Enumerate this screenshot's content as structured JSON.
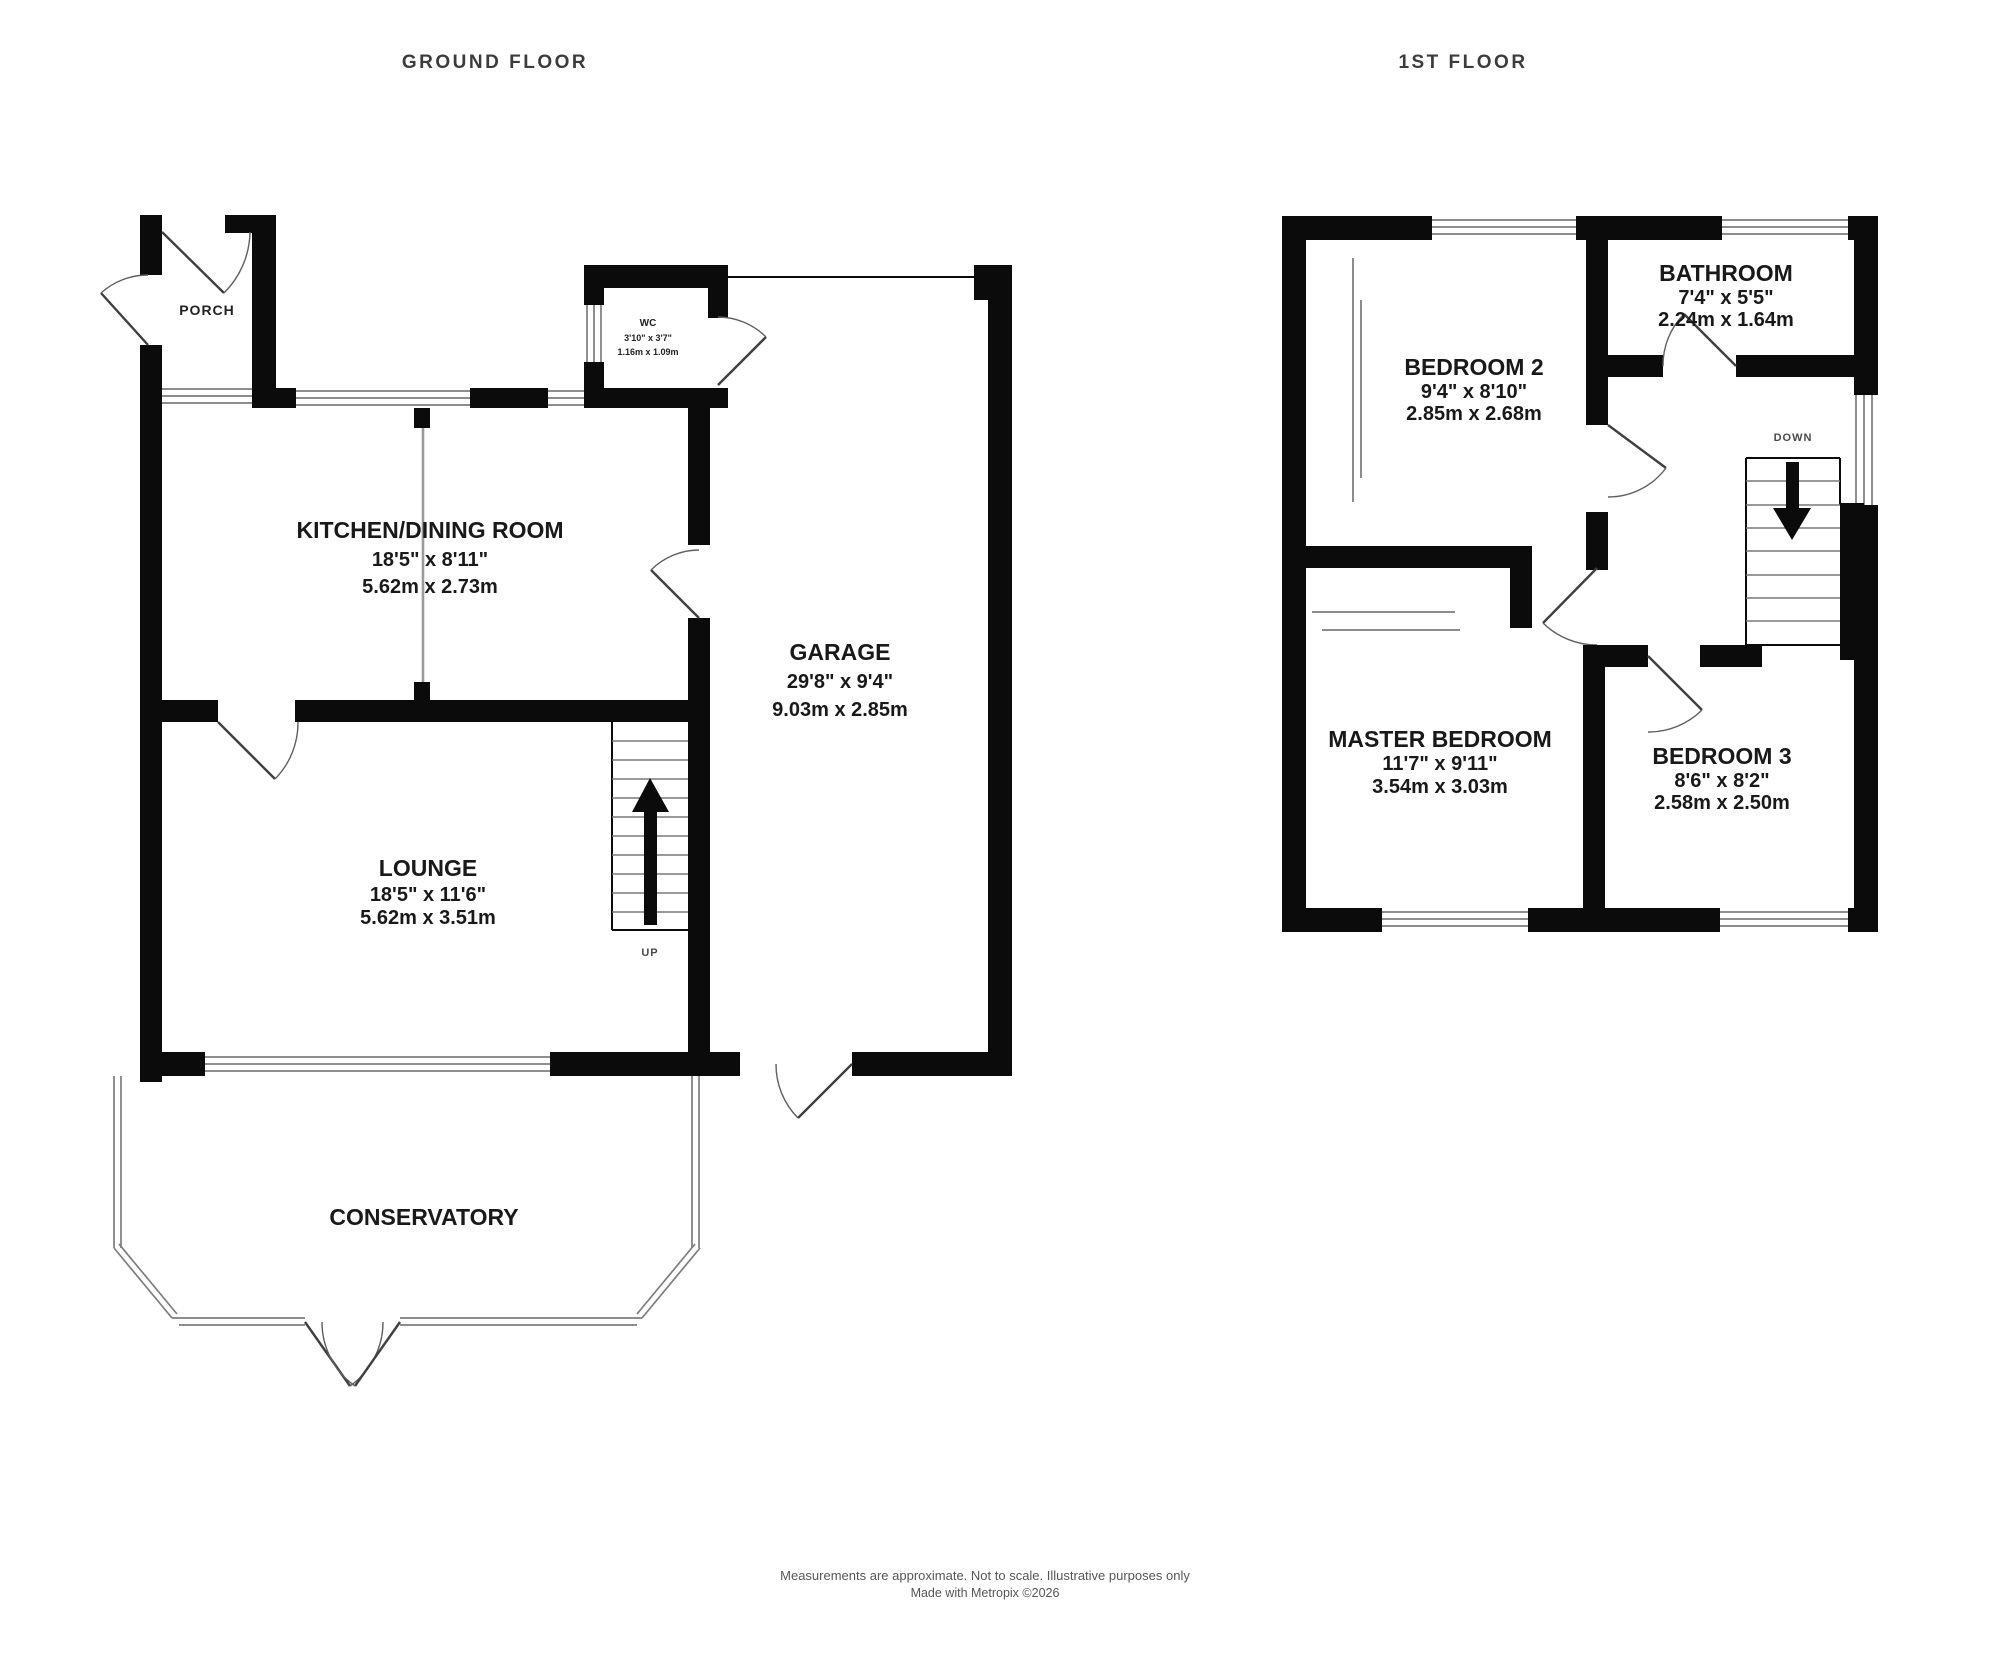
{
  "titles": {
    "ground": "GROUND FLOOR",
    "first": "1ST FLOOR"
  },
  "colors": {
    "wall": "#0b0b0b",
    "window_line": "#7d7d7d",
    "furniture_line": "#9a9a9a",
    "text": "#191919"
  },
  "ground": {
    "porch": {
      "label": "PORCH"
    },
    "wc": {
      "label": "WC",
      "imperial": "3'10\" x 3'7\"",
      "metric": "1.16m x 1.09m"
    },
    "kitchen": {
      "label": "KITCHEN/DINING ROOM",
      "imperial": "18'5\"  x 8'11\"",
      "metric": "5.62m  x 2.73m"
    },
    "garage": {
      "label": "GARAGE",
      "imperial": "29'8\"  x 9'4\"",
      "metric": "9.03m  x 2.85m"
    },
    "lounge": {
      "label": "LOUNGE",
      "imperial": "18'5\"  x 11'6\"",
      "metric": "5.62m  x 3.51m"
    },
    "conservatory": {
      "label": "CONSERVATORY"
    },
    "stairs": {
      "label": "UP"
    }
  },
  "first": {
    "bedroom2": {
      "label": "BEDROOM 2",
      "imperial": "9'4\"  x 8'10\"",
      "metric": "2.85m  x 2.68m"
    },
    "bathroom": {
      "label": "BATHROOM",
      "imperial": "7'4\"  x 5'5\"",
      "metric": "2.24m  x 1.64m"
    },
    "master": {
      "label": "MASTER BEDROOM",
      "imperial": "11'7\"  x 9'11\"",
      "metric": "3.54m  x 3.03m"
    },
    "bedroom3": {
      "label": "BEDROOM 3",
      "imperial": "8'6\"  x 8'2\"",
      "metric": "2.58m  x 2.50m"
    },
    "stairs": {
      "label": "DOWN"
    }
  },
  "footer": {
    "line1": "Measurements are approximate.  Not to scale.  Illustrative purposes only",
    "line2": "Made with Metropix ©2026"
  }
}
